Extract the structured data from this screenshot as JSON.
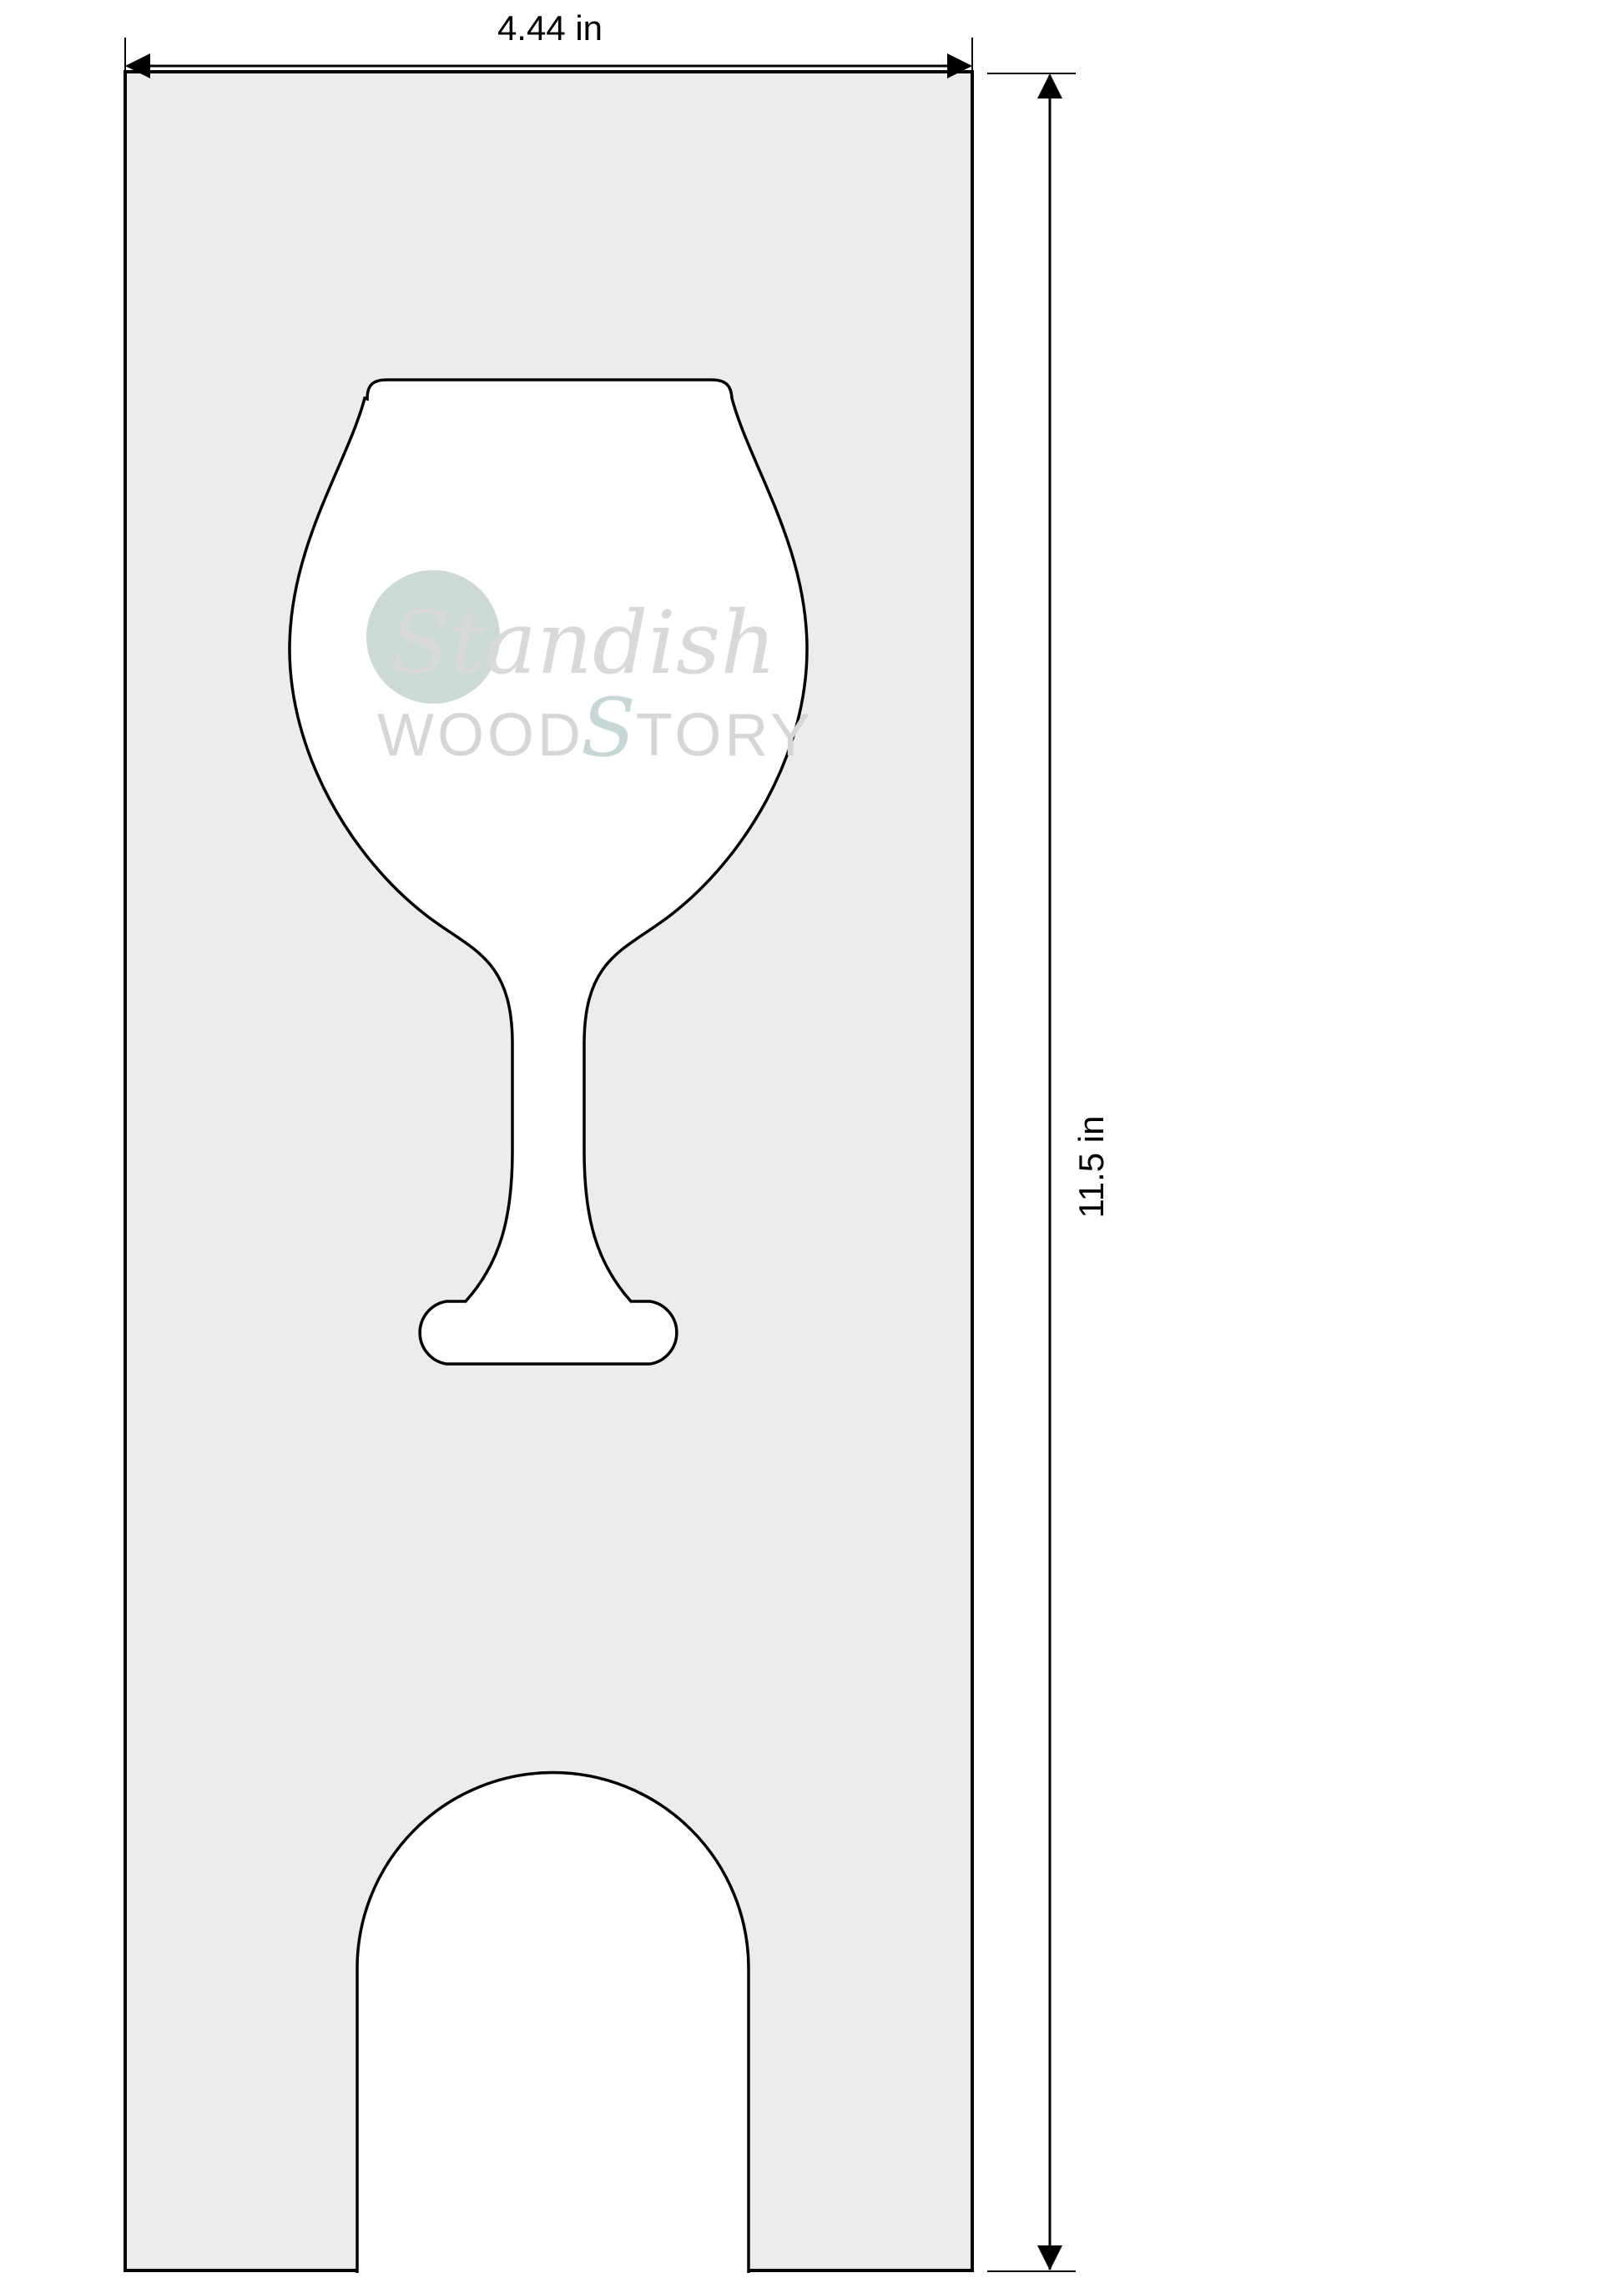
{
  "page": {
    "background": "#ffffff"
  },
  "dimensions": {
    "width_label": "4.44 in",
    "height_label": "11.5 in"
  },
  "panel": {
    "fill": "#ebedec",
    "stroke": "#000000"
  },
  "cutouts": {
    "fill": "#ffffff",
    "stroke": "#000000"
  },
  "logo": {
    "script_word": "Standish",
    "wordmark_left": "WOOD",
    "wordmark_script": "S",
    "wordmark_right": "TORY",
    "circle_fill": "#ccd9d7",
    "script_fill": "#d8dad9",
    "wordmark_fill": "#d5d7d6",
    "wordmark_script_fill": "#c6d7d6"
  }
}
